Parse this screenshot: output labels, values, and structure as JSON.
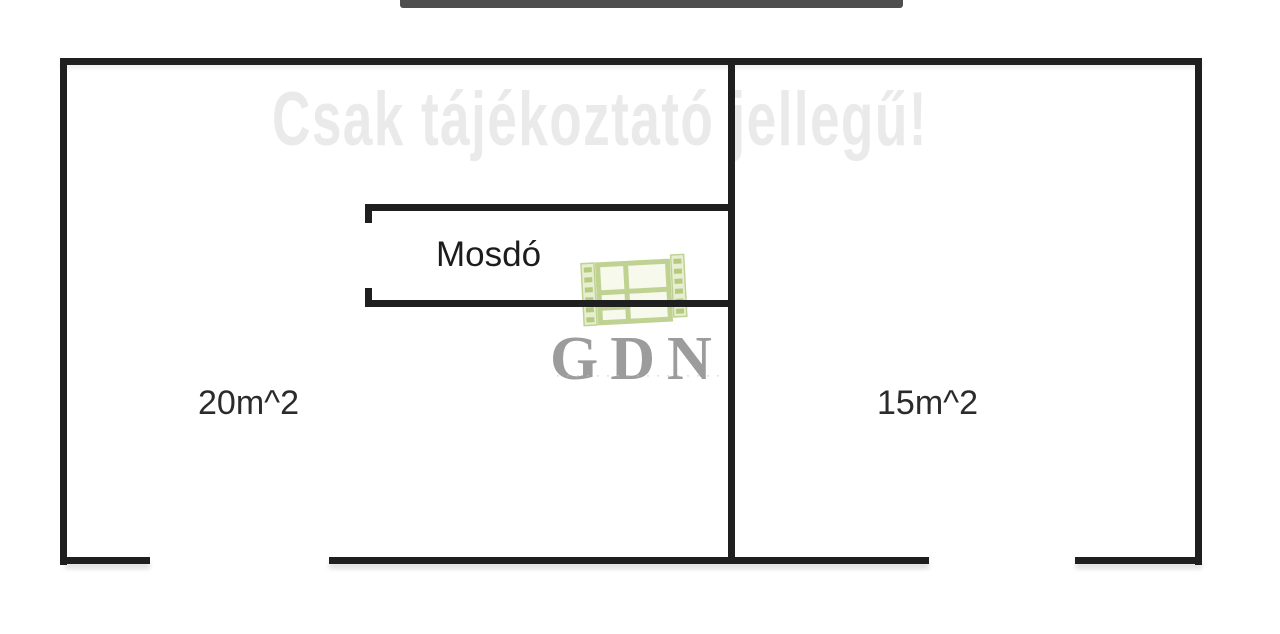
{
  "top_bar": {
    "color": "#4e4e4e"
  },
  "watermark": {
    "text": "Csak tájékoztató jellegű!",
    "color": "#eaeaea"
  },
  "plan": {
    "wall_color": "#1f1f1f",
    "rooms": [
      {
        "id": "left-room",
        "area_label": "20m^2"
      },
      {
        "id": "right-room",
        "area_label": "15m^2"
      },
      {
        "id": "washroom",
        "name_label": "Mosdó"
      }
    ]
  },
  "logo": {
    "name": "GDN",
    "tagline_dots": "·················",
    "text_color": "#9c9c9c",
    "icon": "window-film-logo-icon",
    "icon_color": "#b5cb80"
  }
}
